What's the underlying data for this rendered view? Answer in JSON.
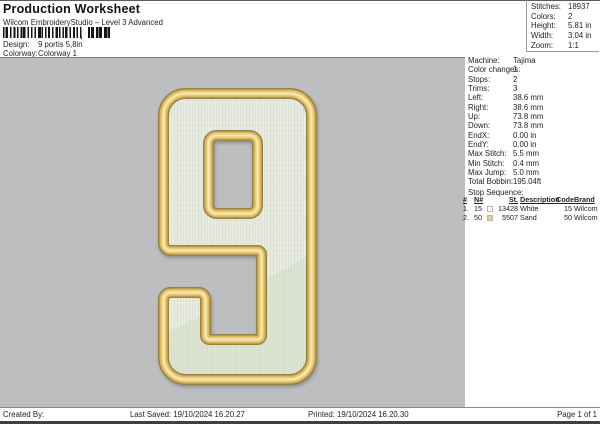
{
  "header": {
    "title": "Production Worksheet",
    "subtitle": "Wilcom EmbroideryStudio – Level 3 Advanced",
    "barcode_separator": ",",
    "design_label": "Design:",
    "design_value": "9 portis 5,8in",
    "colorway_label": "Colorway:",
    "colorway_value": "Colorway 1"
  },
  "stats": {
    "rows": [
      {
        "label": "Stitches:",
        "value": "18937"
      },
      {
        "label": "Colors:",
        "value": "2"
      },
      {
        "label": "Height:",
        "value": "5.81 in"
      },
      {
        "label": "Width:",
        "value": "3.04 in"
      },
      {
        "label": "Zoom:",
        "value": "1:1"
      }
    ]
  },
  "machine_panel": {
    "rows": [
      {
        "label": "Machine:",
        "value": "Tajima"
      },
      {
        "label": "Color changes:",
        "value": "1"
      },
      {
        "label": "Stops:",
        "value": "2"
      },
      {
        "label": "Trims:",
        "value": "3"
      },
      {
        "label": "Left:",
        "value": "38.6 mm"
      },
      {
        "label": "Right:",
        "value": "38.6 mm"
      },
      {
        "label": "Up:",
        "value": "73.8 mm"
      },
      {
        "label": "Down:",
        "value": "73.8 mm"
      },
      {
        "label": "EndX:",
        "value": "0.00 in"
      },
      {
        "label": "EndY:",
        "value": "0.00 in"
      },
      {
        "label": "Max Stitch:",
        "value": "5.5 mm"
      },
      {
        "label": "Min Stitch:",
        "value": "0.4 mm"
      },
      {
        "label": "Max Jump:",
        "value": "5.0 mm"
      },
      {
        "label": "Total Bobbin:",
        "value": "195.04ft"
      }
    ],
    "stop_sequence_label": "Stop Sequence:",
    "table": {
      "headers": [
        "#",
        "N#",
        "St.",
        "Description",
        "Code",
        "Brand"
      ],
      "rows": [
        {
          "num": "1.",
          "n": "15",
          "swatch": "#ffffff",
          "st": "13428",
          "description": "White",
          "code": "15",
          "brand": "Wilcom"
        },
        {
          "num": "2.",
          "n": "50",
          "swatch": "#eac98d",
          "st": "5507",
          "description": "Sand",
          "code": "50",
          "brand": "Wilcom"
        }
      ]
    }
  },
  "design": {
    "name": "numeral 9 embroidery preview",
    "colors": {
      "canvas_bg": "#bdbec0",
      "outline_dark": "#9a8140",
      "outline_mid": "#d6b65f",
      "outline_light": "#eed289",
      "outline_highlight": "#f8ecb0",
      "fill_top": "#e9ece2",
      "fill_bottom": "#dde4d3"
    }
  },
  "footer": {
    "created_by": "Created By:",
    "last_saved": "Last Saved: 19/10/2024 16.20.27",
    "printed": "Printed: 19/10/2024 16.20.30",
    "page": "Page 1 of 1"
  }
}
